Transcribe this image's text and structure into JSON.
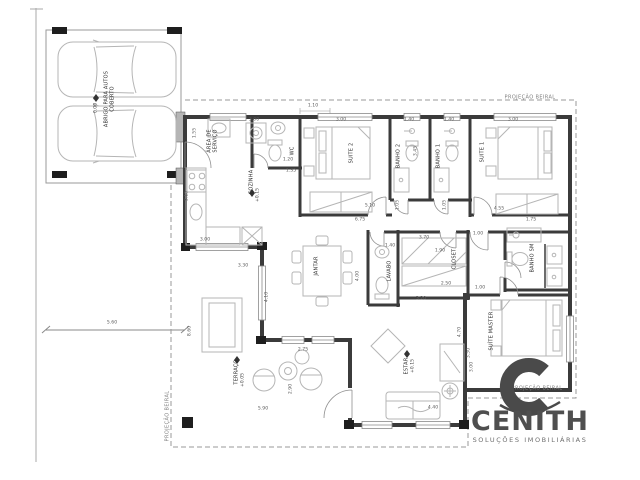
{
  "brand": {
    "name": "CENITH",
    "tagline": "SOLUÇÕES IMOBILIÁRIAS"
  },
  "icons": {
    "level_marker": "◆"
  },
  "annotations": {
    "roof_projection": "PROJEÇÃO BEIRAL"
  },
  "rooms": {
    "carport_l1": "ABRIGO PARA AUTOS",
    "carport_l2": "COBERTO",
    "carport_level": "0.00",
    "servico_l1": "ÁREA DE",
    "servico_l2": "SERVIÇO",
    "wc": "WC",
    "cozinha": "COZINHA",
    "cozinha_level": "+0.15",
    "suite2": "SUITE 2",
    "banho2": "BANHO 2",
    "banho1": "BANHO 1",
    "suite1": "SUITE 1",
    "jantar": "JANTAR",
    "lavabo": "LAVABO",
    "closet": "CLOSET",
    "banho_sm": "BANHO SM",
    "suite_master": "SUÍTE MASTER",
    "estar": "ESTAR",
    "estar_level": "+0.15",
    "terraco": "TERRAÇO",
    "terraco_level": "+0.05"
  },
  "dims": [
    "5.60",
    "8.60",
    "1.55",
    "3.00",
    "1.20",
    "1.35",
    "3.15",
    "1.10",
    "3.00",
    "1.40",
    "1.40",
    "3.00",
    "3.45",
    "5.10",
    "4.55",
    "1.75",
    "6.75",
    "4.10",
    "3.70",
    "1.90",
    "1.00",
    "1.40",
    "4.00",
    "2.50",
    "3.20",
    "1.00",
    "3.30",
    "3.50",
    "4.70",
    "3.00",
    "4.40",
    "2.75",
    "2.90",
    "5.90",
    "3.00",
    "3.30",
    "1.05",
    "1.05"
  ]
}
